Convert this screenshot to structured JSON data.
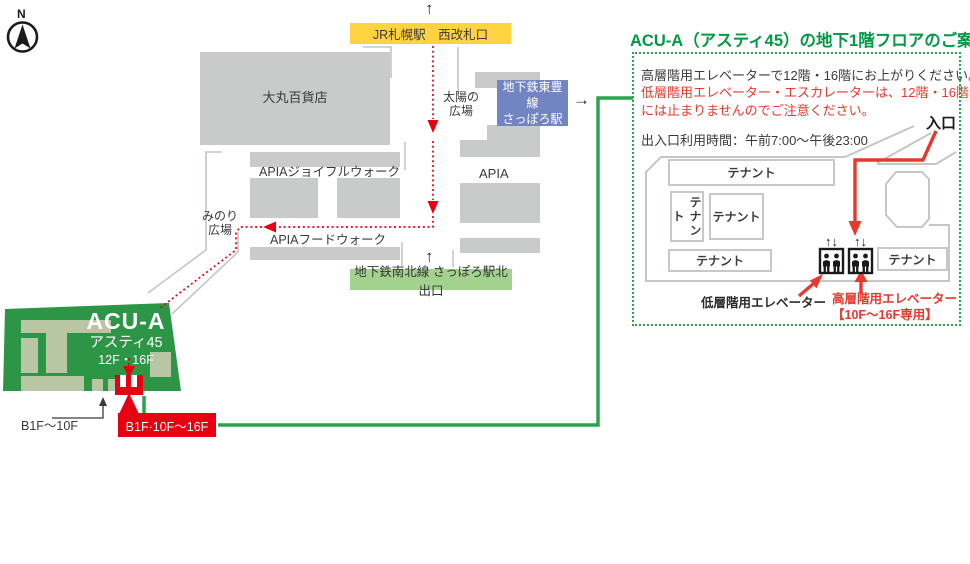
{
  "colors": {
    "accent_green": "#009944",
    "route_line_green": "#2aa44e",
    "building_green": "#2d9646",
    "building_inner_green": "#b9c6a3",
    "route_red": "#e60012",
    "arrow_red": "#e8382d",
    "jr_box_yellow": "#ffd23f",
    "toho_box_blue": "#7384c3",
    "namboku_box_green": "#a3d28f",
    "block_gray": "#c9caca"
  },
  "map": {
    "compass": "N",
    "jr_exit_label": "JR札幌駅　西改札口",
    "daimaru_label": "大丸百貨店",
    "taiyo_plaza": {
      "line1": "太陽の",
      "line2": "広場"
    },
    "toho_station": {
      "line1": "地下鉄東豊線",
      "line2": "さっぽろ駅"
    },
    "apia_label": "APIA",
    "apia_joyful_label": "APIAジョイフルウォーク",
    "apia_food_label": "APIAフードウォーク",
    "minori_plaza": {
      "line1": "みのり",
      "line2": "広場"
    },
    "namboku_exit_label": "地下鉄南北線 さっぽろ駅北出口",
    "acu_building": {
      "name": "ACU-A",
      "subname": "アスティ45",
      "floors": "12F・16F"
    },
    "b1f_label": "B1F～10F",
    "elevator_bank_label": "B1F·10F～16F"
  },
  "panel": {
    "title": "ACU-A（アスティ45）の地下1階フロアのご案内",
    "note_line1": "高層階用エレベーターで12階・16階にお上がりください。",
    "note_line2": "低層階用エレベーター・エスカレーターは、12階・16階",
    "note_line3": "には止まりませんのでご注意ください。",
    "hours": "出入口利用時間：午前7:00～午後23:00",
    "entrance_label": "入口",
    "tenant_label": "テナント",
    "low_elevator_label": "低層階用エレベーター",
    "high_elevator_label": "高層階用エレベーター",
    "high_elevator_note": "【10F～16F専用】"
  },
  "glyphs": {
    "up_arrow": "↑",
    "right_arrow": "→",
    "elevator_arrows": "↑↓"
  }
}
